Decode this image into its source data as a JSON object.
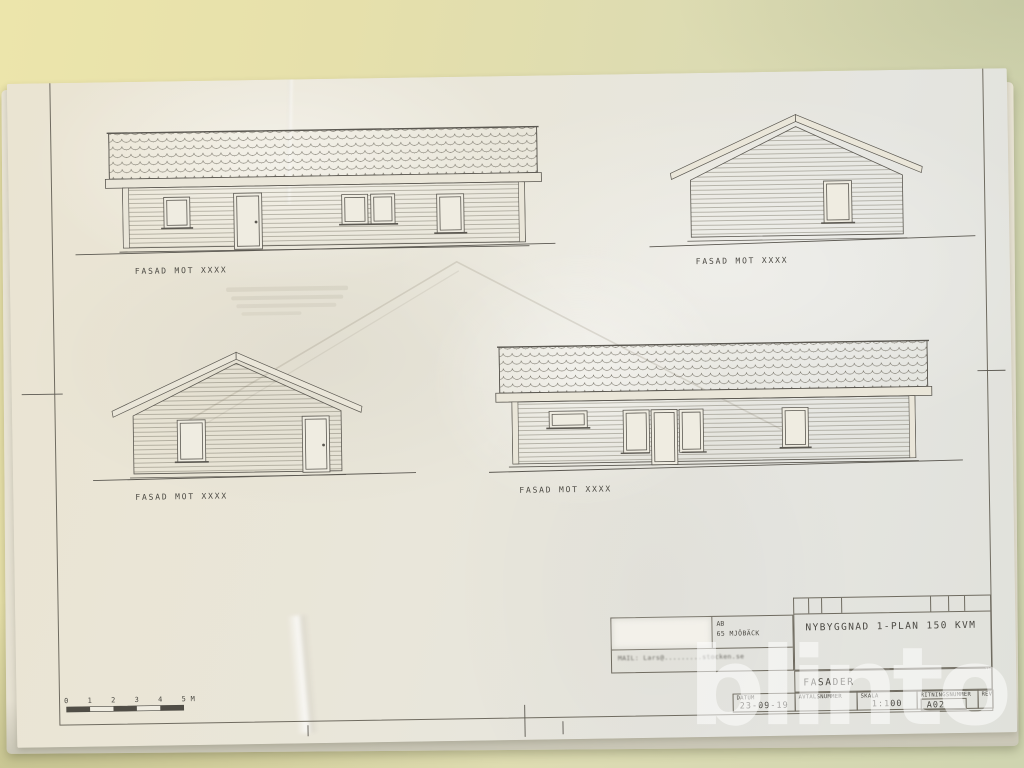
{
  "facades": [
    {
      "label": "FASAD MOT XXXX"
    },
    {
      "label": "FASAD MOT XXXX"
    },
    {
      "label": "FASAD MOT XXXX"
    },
    {
      "label": "FASAD MOT XXXX"
    }
  ],
  "scalebar": {
    "labels": [
      "0",
      "1",
      "2",
      "3",
      "4",
      "5"
    ],
    "unit": "M"
  },
  "title_block": {
    "company": "AB",
    "address": "65 MJÖBÄCK",
    "mail": "MAIL: Lars@.........stocken.se",
    "project": "NYBYGGNAD 1-PLAN 150 KVM",
    "drawing_name": "FASADER",
    "fields": [
      {
        "label": "DATUM",
        "value": "23-09-19"
      },
      {
        "label": "AVTALSNUMMER",
        "value": ""
      },
      {
        "label": "SKALA",
        "value": "1:100"
      },
      {
        "label": "RITNINGSNUMMER",
        "value": "A02"
      },
      {
        "label": "REV",
        "value": ""
      }
    ]
  },
  "watermark": {
    "text": "blinto",
    "tm": "™"
  },
  "colors": {
    "paper": "#e9e5d7",
    "ink": "#4c4a44",
    "background": "#e4dfae",
    "watermark": "rgba(255,255,255,0.52)"
  }
}
